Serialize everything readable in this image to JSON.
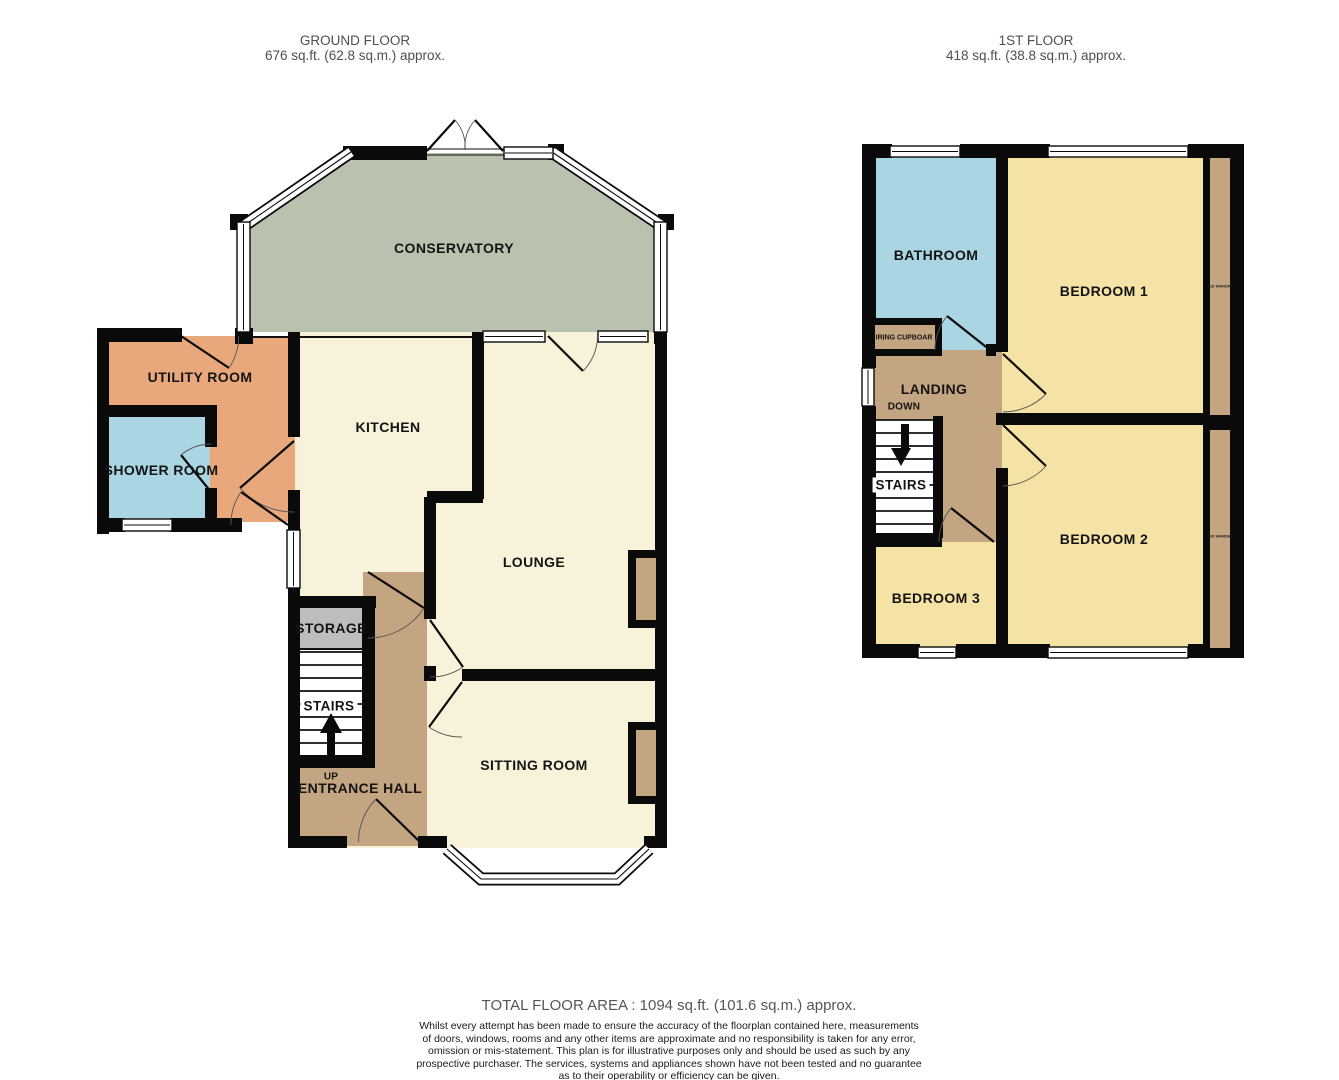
{
  "ground_floor": {
    "title": "GROUND FLOOR",
    "area": "676 sq.ft. (62.8 sq.m.) approx.",
    "rooms": {
      "conservatory": "CONSERVATORY",
      "utility": "UTILITY ROOM",
      "kitchen": "KITCHEN",
      "shower": "SHOWER ROOM",
      "lounge": "LOUNGE",
      "storage": "STORAGE",
      "stairs": "STAIRS",
      "up": "UP",
      "hall": "ENTRANCE HALL",
      "sitting": "SITTING ROOM"
    }
  },
  "first_floor": {
    "title": "1ST FLOOR",
    "area": "418 sq.ft. (38.8 sq.m.) approx.",
    "rooms": {
      "bathroom": "BATHROOM",
      "bedroom1": "BEDROOM 1",
      "airing_cupboard": "AIRING CUPBOARD",
      "landing": "LANDING",
      "down": "DOWN",
      "stairs": "STAIRS",
      "bedroom2": "BEDROOM 2",
      "bedroom3": "BEDROOM 3",
      "wardrobe": "FITTED WARDROBE"
    }
  },
  "footer": {
    "total": "TOTAL FLOOR AREA : 1094 sq.ft. (101.6 sq.m.) approx.",
    "disclaimer": [
      "Whilst every attempt has been made to ensure the accuracy of the floorplan contained here, measurements",
      "of doors, windows, rooms and any other items are approximate and no responsibility is taken for any error,",
      "omission or mis-statement. This plan is for illustrative purposes only and should be used as such by any",
      "prospective purchaser. The services, systems and appliances shown have not been tested and no guarantee",
      "as to their operability or efficiency can be given."
    ],
    "credit": "Made with Metropix ©2026"
  },
  "colors": {
    "room_cream": "#f8f2da",
    "conservatory_green": "#b9c2af",
    "utility_orange": "#e8a87c",
    "wet_room_blue": "#aad5e3",
    "hall_tan": "#c4a581",
    "storage_gray": "#bdbdbd",
    "wall_black": "#0a0a0a",
    "bedroom_yellow": "#f5e3a6"
  }
}
